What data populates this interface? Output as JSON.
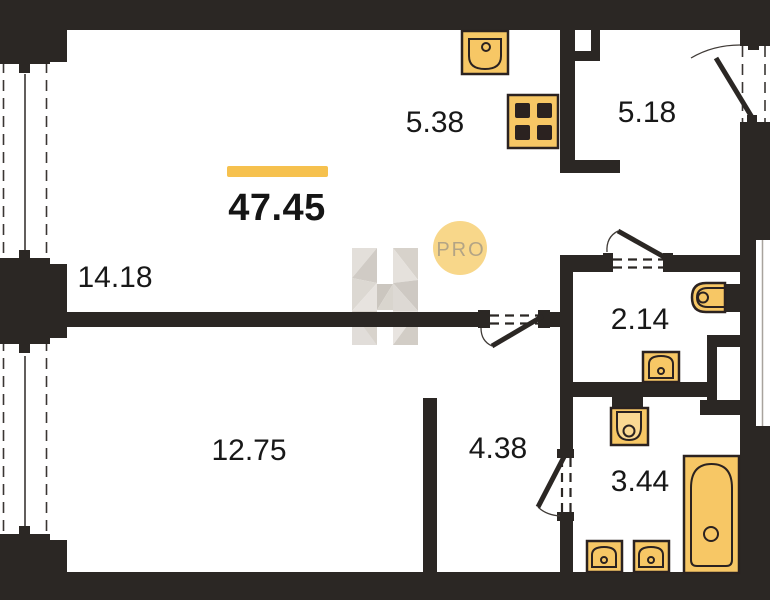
{
  "theme": {
    "wall": "#2b2724",
    "accent": "#f6c14e",
    "fixture": "#f7c765",
    "fixture_light": "#fbd993",
    "stroke": "#2b2220",
    "badge": "#f8d78a",
    "badge_text": "#b3a485",
    "label": "#181818"
  },
  "total": {
    "area": "47.45"
  },
  "rooms": {
    "living": {
      "area": "14.18"
    },
    "kitchen": {
      "area": "5.38"
    },
    "loggia": {
      "area": "5.18"
    },
    "hall": {
      "area": "2.14"
    },
    "bedroom": {
      "area": "12.75"
    },
    "corridor": {
      "area": "4.38"
    },
    "bathroom": {
      "area": "3.44"
    }
  },
  "watermark": {
    "letter": "H",
    "badge": "PRO"
  }
}
